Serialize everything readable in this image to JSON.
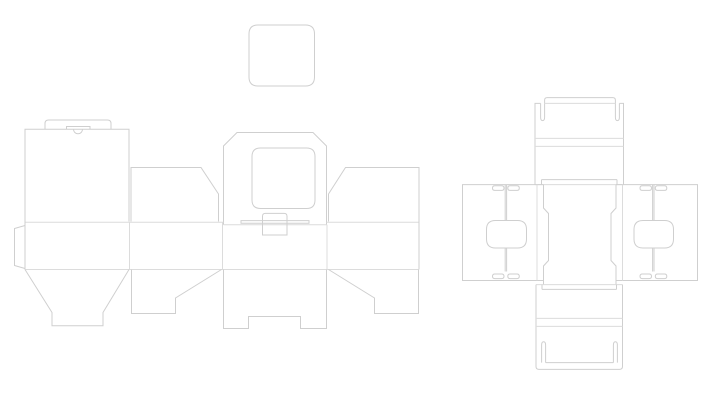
{
  "app": {
    "title": "packaging-dieline-drawing",
    "background_color": "#ffffff",
    "cut_line_color": "#cfcfcf",
    "crease_line_color": "#dcdcdc",
    "stroke_width": 1
  },
  "drawing": {
    "width": 720,
    "height": 400,
    "groups": [
      {
        "name": "lid-blank",
        "shapes": [
          {
            "name": "rounded-square-lid",
            "kind": "cut",
            "d": "M258,25 H305.5 Q314.5,25 314.5,34 V77 Q314.5,86 305.5,86 H258 Q249,86 249,77 V34 Q249,25 258,25 Z"
          }
        ]
      },
      {
        "name": "left-dieline",
        "shapes": [
          {
            "name": "back-panel",
            "kind": "cut",
            "d": "M25,221.5 V129.3 H129 V221.5"
          },
          {
            "name": "tuck-lid-tab",
            "kind": "cut",
            "d": "M45,129.3 V123.5 Q45,120 48.5,120 H107.5 Q111,120 111,123.5 V129.3"
          },
          {
            "name": "thumb-slit",
            "kind": "cut",
            "d": "M66.5,129.3 V126.5 H90 V129.3"
          },
          {
            "name": "thumb-notch-arc",
            "kind": "cut",
            "d": "M73.5,129.3 A4.5,4.5 0 0 0 82.5,129.3"
          },
          {
            "name": "glue-tab",
            "kind": "cut",
            "d": "M25,225.5 L14.5,228.5 V265.5 L25,268.5"
          },
          {
            "name": "dust-flap-left",
            "kind": "cut",
            "d": "M131,221.5 V167.5 H201 L218.5,194 V221.5"
          },
          {
            "name": "window-flap",
            "kind": "cut",
            "d": "M223.5,224.8 V146 L237,132.5 H313 L326.5,146 V224.8"
          },
          {
            "name": "window-cutout",
            "kind": "cut",
            "d": "M260.5,148 H306.5 Q315,148 315,156.5 V200 Q315,208.5 306.5,208.5 H260.5 Q252,208.5 252,200 V156.5 Q252,148 260.5,148 Z"
          },
          {
            "name": "lock-slot",
            "kind": "cut",
            "d": "M241,220.6 H309 V223.2 H241 Z"
          },
          {
            "name": "fold-top-a",
            "kind": "crease",
            "d": "M25,222.3 H223.5"
          },
          {
            "name": "fold-top-b",
            "kind": "crease",
            "d": "M326.5,222.3 H419"
          },
          {
            "name": "fold-center-flap",
            "kind": "crease",
            "d": "M223.5,224.8 H326.5"
          },
          {
            "name": "tuck-tab",
            "kind": "cut",
            "fill": "#ffffff",
            "d": "M262.5,235 V216.2 Q262.5,213.4 265.3,213.4 H284.2 Q287,213.4 287,216.2 V235 Z"
          },
          {
            "name": "dust-flap-right",
            "kind": "cut",
            "d": "M328.5,221.5 V194 L345.5,167.5 H419 V221.5"
          },
          {
            "name": "body-crease-1",
            "kind": "crease",
            "d": "M129.5,222.3 V269.5"
          },
          {
            "name": "body-crease-2",
            "kind": "crease",
            "d": "M222.5,222.3 V269.5"
          },
          {
            "name": "body-crease-3",
            "kind": "crease",
            "d": "M327,224.8 V269.5"
          },
          {
            "name": "body-left-edge",
            "kind": "cut",
            "d": "M25,221.5 V269.5"
          },
          {
            "name": "body-right-edge",
            "kind": "cut",
            "d": "M419,221.5 V269.5"
          },
          {
            "name": "fold-bottom",
            "kind": "crease",
            "d": "M25,269.5 H419"
          },
          {
            "name": "bucket-flap",
            "kind": "cut",
            "d": "M25,269.5 L52,312.5 V325.8 H103 V312.5 L129,269.5"
          },
          {
            "name": "lock-flap-left",
            "kind": "cut",
            "d": "M131.5,269.5 V313.5 H175.5 V298 L221.5,269.5"
          },
          {
            "name": "center-bottom-flap",
            "kind": "cut",
            "d": "M223.5,269.5 V328.5 H248.5 V316.5 H300.5 V328.5 H326.5 V269.5"
          },
          {
            "name": "lock-flap-right",
            "kind": "cut",
            "d": "M418.5,269.5 V313.5 H374.5 V298 L328.5,269.5"
          }
        ]
      },
      {
        "name": "right-dieline-top-flap",
        "shapes": [
          {
            "name": "flap-left-edge",
            "kind": "cut",
            "d": "M535,184.6 V103.4 H540.6"
          },
          {
            "name": "hook-slit-left",
            "kind": "cut",
            "d": "M540.6,103.4 V117.2 Q540.6,120.6 542.6,120.6 Q544.6,120.6 544.6,117.2 V103.4"
          },
          {
            "name": "tuck-tab-top",
            "kind": "cut",
            "d": "M544.6,103.4 V100.2 Q544.6,97.6 547.2,97.6 H612.8 Q615.4,97.6 615.4,100.2 V103.4"
          },
          {
            "name": "tuck-tab-fold",
            "kind": "crease",
            "d": "M544.6,103.4 H615.4"
          },
          {
            "name": "hook-slit-right",
            "kind": "cut",
            "d": "M615.4,103.4 V117.2 Q615.4,120.6 617.4,120.6 Q619.4,120.6 619.4,117.2 V103.4"
          },
          {
            "name": "flap-right-edge",
            "kind": "cut",
            "d": "M619.4,103.4 H623.5 V184.6"
          },
          {
            "name": "flap-bottom-cut",
            "kind": "cut",
            "d": "M541.5,179.6 H617"
          },
          {
            "name": "flap-step-left",
            "kind": "cut",
            "d": "M541.5,179.6 V184.6"
          },
          {
            "name": "flap-step-right",
            "kind": "cut",
            "d": "M617,179.6 V184.6"
          },
          {
            "name": "flap-crease-1",
            "kind": "crease",
            "d": "M535,138.4 H623.5"
          },
          {
            "name": "flap-crease-2",
            "kind": "crease",
            "d": "M535,146.4 H623.5"
          },
          {
            "name": "flap-fold",
            "kind": "crease",
            "d": "M535,184.6 H623.5"
          }
        ]
      },
      {
        "name": "right-dieline-column",
        "shapes": [
          {
            "name": "column-left-edge",
            "kind": "cut",
            "d": "M543.5,184.6 V208 L548.5,213.5 V260.5 L543.5,266 V284.6"
          },
          {
            "name": "column-right-edge",
            "kind": "cut",
            "d": "M616,184.6 V208 L611,213.5 V260.5 L616,266 V284.6"
          },
          {
            "name": "column-bottom-fold",
            "kind": "crease",
            "d": "M536,284.6 H622.5"
          }
        ]
      },
      {
        "name": "right-dieline-left-wing",
        "shapes": [
          {
            "name": "wing-outline",
            "kind": "cut",
            "d": "M543.5,184.6 H462.5 V280.5 H543.5"
          },
          {
            "name": "wing-crease",
            "kind": "crease",
            "d": "M537,184.6 V280.5"
          },
          {
            "name": "lock-ear",
            "kind": "cut",
            "d": "M494.8,185.8 H501.7 Q504,185.8 504,188.1 Q504,190.4 501.7,190.4 H494.8 Q492.5,190.4 492.5,188.1 Q492.5,185.8 494.8,185.8 Z"
          },
          {
            "name": "lock-ear",
            "kind": "cut",
            "d": "M510.1,185.8 H517 Q519.3,185.8 519.3,188.1 Q519.3,190.4 517,190.4 H510.1 Q507.8,190.4 507.8,188.1 Q507.8,185.8 510.1,185.8 Z"
          },
          {
            "name": "lock-ear",
            "kind": "cut",
            "d": "M494.8,274 H501.7 Q504,274 504,276.3 Q504,278.6 501.7,278.6 H494.8 Q492.5,278.6 492.5,276.3 Q492.5,274 494.8,274 Z"
          },
          {
            "name": "lock-ear",
            "kind": "cut",
            "d": "M510.1,274 H517 Q519.3,274 519.3,276.3 Q519.3,278.6 517,278.6 H510.1 Q507.8,278.6 507.8,276.3 Q507.8,274 510.1,274 Z"
          },
          {
            "name": "center-slit",
            "kind": "cut",
            "d": "M505.2,184.6 V220.5"
          },
          {
            "name": "center-slit",
            "kind": "cut",
            "d": "M506.6,184.6 V220.5"
          },
          {
            "name": "center-slit",
            "kind": "cut",
            "d": "M505.2,248 V271.5"
          },
          {
            "name": "center-slit",
            "kind": "cut",
            "d": "M506.6,248 V271.5"
          },
          {
            "name": "rounded-cutout",
            "kind": "cut",
            "d": "M495.5,220.5 H517.5 Q526.5,220.5 526.5,229.5 V239 Q526.5,248 517.5,248 H495.5 Q486.5,248 486.5,239 V229.5 Q486.5,220.5 495.5,220.5 Z"
          }
        ]
      },
      {
        "name": "right-dieline-right-wing",
        "shapes": [
          {
            "name": "wing-outline",
            "kind": "cut",
            "d": "M616,184.6 H697.5 V280.5 H616"
          },
          {
            "name": "wing-crease",
            "kind": "crease",
            "d": "M622.5,184.6 V280.5"
          },
          {
            "name": "lock-ear",
            "kind": "cut",
            "d": "M642.3,185.8 H649.2 Q651.5,185.8 651.5,188.1 Q651.5,190.4 649.2,190.4 H642.3 Q640,190.4 640,188.1 Q640,185.8 642.3,185.8 Z"
          },
          {
            "name": "lock-ear",
            "kind": "cut",
            "d": "M657.6,185.8 H664.5 Q666.8,185.8 666.8,188.1 Q666.8,190.4 664.5,190.4 H657.6 Q655.3,190.4 655.3,188.1 Q655.3,185.8 657.6,185.8 Z"
          },
          {
            "name": "lock-ear",
            "kind": "cut",
            "d": "M642.3,274 H649.2 Q651.5,274 651.5,276.3 Q651.5,278.6 649.2,278.6 H642.3 Q640,278.6 640,276.3 Q640,274 642.3,274 Z"
          },
          {
            "name": "lock-ear",
            "kind": "cut",
            "d": "M657.6,274 H664.5 Q666.8,274 666.8,276.3 Q666.8,278.6 664.5,278.6 H657.6 Q655.3,278.6 655.3,276.3 Q655.3,274 657.6,274 Z"
          },
          {
            "name": "center-slit",
            "kind": "cut",
            "d": "M652.6,184.6 V220.5"
          },
          {
            "name": "center-slit",
            "kind": "cut",
            "d": "M654,184.6 V220.5"
          },
          {
            "name": "center-slit",
            "kind": "cut",
            "d": "M652.6,248 V271.5"
          },
          {
            "name": "center-slit",
            "kind": "cut",
            "d": "M654,248 V271.5"
          },
          {
            "name": "rounded-cutout",
            "kind": "cut",
            "d": "M643,220.5 H664.5 Q673.5,220.5 673.5,229.5 V239 Q673.5,248 664.5,248 H643 Q634,248 634,239 V229.5 Q634,220.5 643,220.5 Z"
          }
        ]
      },
      {
        "name": "right-dieline-bottom-flap",
        "shapes": [
          {
            "name": "flap-outline",
            "kind": "cut",
            "d": "M536,284.6 V366.5 Q536,369.4 539,369.4 H619.5 Q622.5,369.4 622.5,366.5 V284.6"
          },
          {
            "name": "flap-step-left",
            "kind": "cut",
            "d": "M542,284.6 V289.4"
          },
          {
            "name": "flap-step-right",
            "kind": "cut",
            "d": "M616.5,284.6 V289.4"
          },
          {
            "name": "flap-top-cut",
            "kind": "cut",
            "d": "M542,289.4 H616.5"
          },
          {
            "name": "flap-crease-1",
            "kind": "crease",
            "d": "M536,318.4 H622.5"
          },
          {
            "name": "flap-crease-2",
            "kind": "crease",
            "d": "M536,326.4 H622.5"
          },
          {
            "name": "hook-slit-left",
            "kind": "cut",
            "d": "M541.6,362.6 V345.2 Q541.6,341.8 543.6,341.8 Q545.6,341.8 545.6,345.2 V362.6"
          },
          {
            "name": "hook-slit-right",
            "kind": "cut",
            "d": "M613.4,362.6 V345.2 Q613.4,341.8 615.4,341.8 Q617.4,341.8 617.4,345.2 V362.6"
          },
          {
            "name": "tuck-tab-fold-bottom",
            "kind": "cut",
            "d": "M545.6,362.6 H613.4"
          }
        ]
      }
    ]
  }
}
